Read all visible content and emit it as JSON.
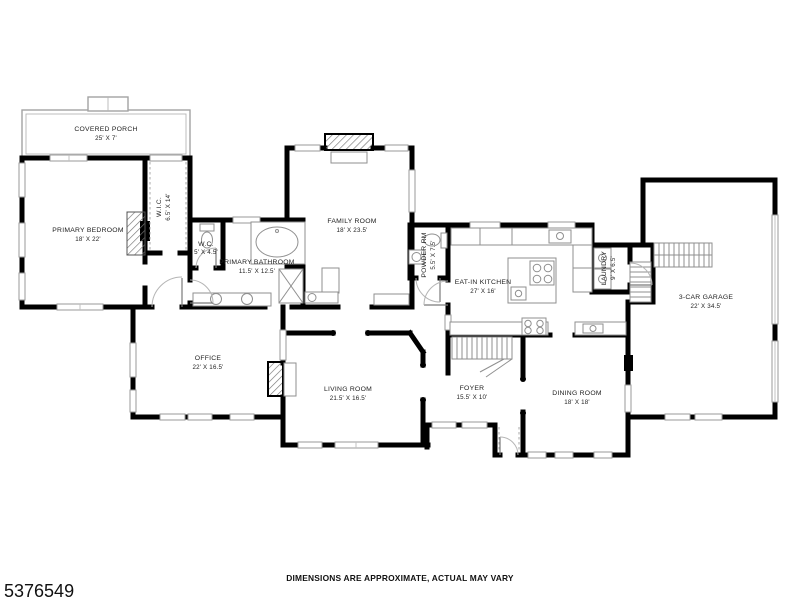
{
  "footer": {
    "listing_id": "5376549",
    "disclaimer": "DIMENSIONS ARE APPROXIMATE, ACTUAL MAY VARY"
  },
  "colors": {
    "background": "#ffffff",
    "walls": "#000000",
    "porch_outline": "#a3a3a3",
    "fixtures": "#8f8f8f"
  },
  "rooms": {
    "covered_porch": {
      "name": "COVERED PORCH",
      "dims": "25' X 7'"
    },
    "primary_bedroom": {
      "name": "PRIMARY BEDROOM",
      "dims": "18' X 22'"
    },
    "wic": {
      "name": "W.I.C.",
      "dims": "6.5' X 14'"
    },
    "wc": {
      "name": "W.C.",
      "dims": "5' X 4.5'"
    },
    "primary_bathroom": {
      "name": "PRIMARY BATHROOM",
      "dims": "11.5' X 12.5'"
    },
    "family_room": {
      "name": "FAMILY ROOM",
      "dims": "18' X 23.5'"
    },
    "powder_rm": {
      "name": "POWDER RM",
      "dims": "5.5' X 7.5'"
    },
    "eat_in_kitchen": {
      "name": "EAT-IN KITCHEN",
      "dims": "27' X 16'"
    },
    "laundry": {
      "name": "LAUNDRY",
      "dims": "9' X 6.5'"
    },
    "garage": {
      "name": "3-CAR GARAGE",
      "dims": "22' X 34.5'"
    },
    "office": {
      "name": "OFFICE",
      "dims": "22' X 16.5'"
    },
    "living_room": {
      "name": "LIVING ROOM",
      "dims": "21.5' X 16.5'"
    },
    "foyer": {
      "name": "FOYER",
      "dims": "15.5' X 10'"
    },
    "dining_room": {
      "name": "DINING ROOM",
      "dims": "18' X 18'"
    }
  }
}
